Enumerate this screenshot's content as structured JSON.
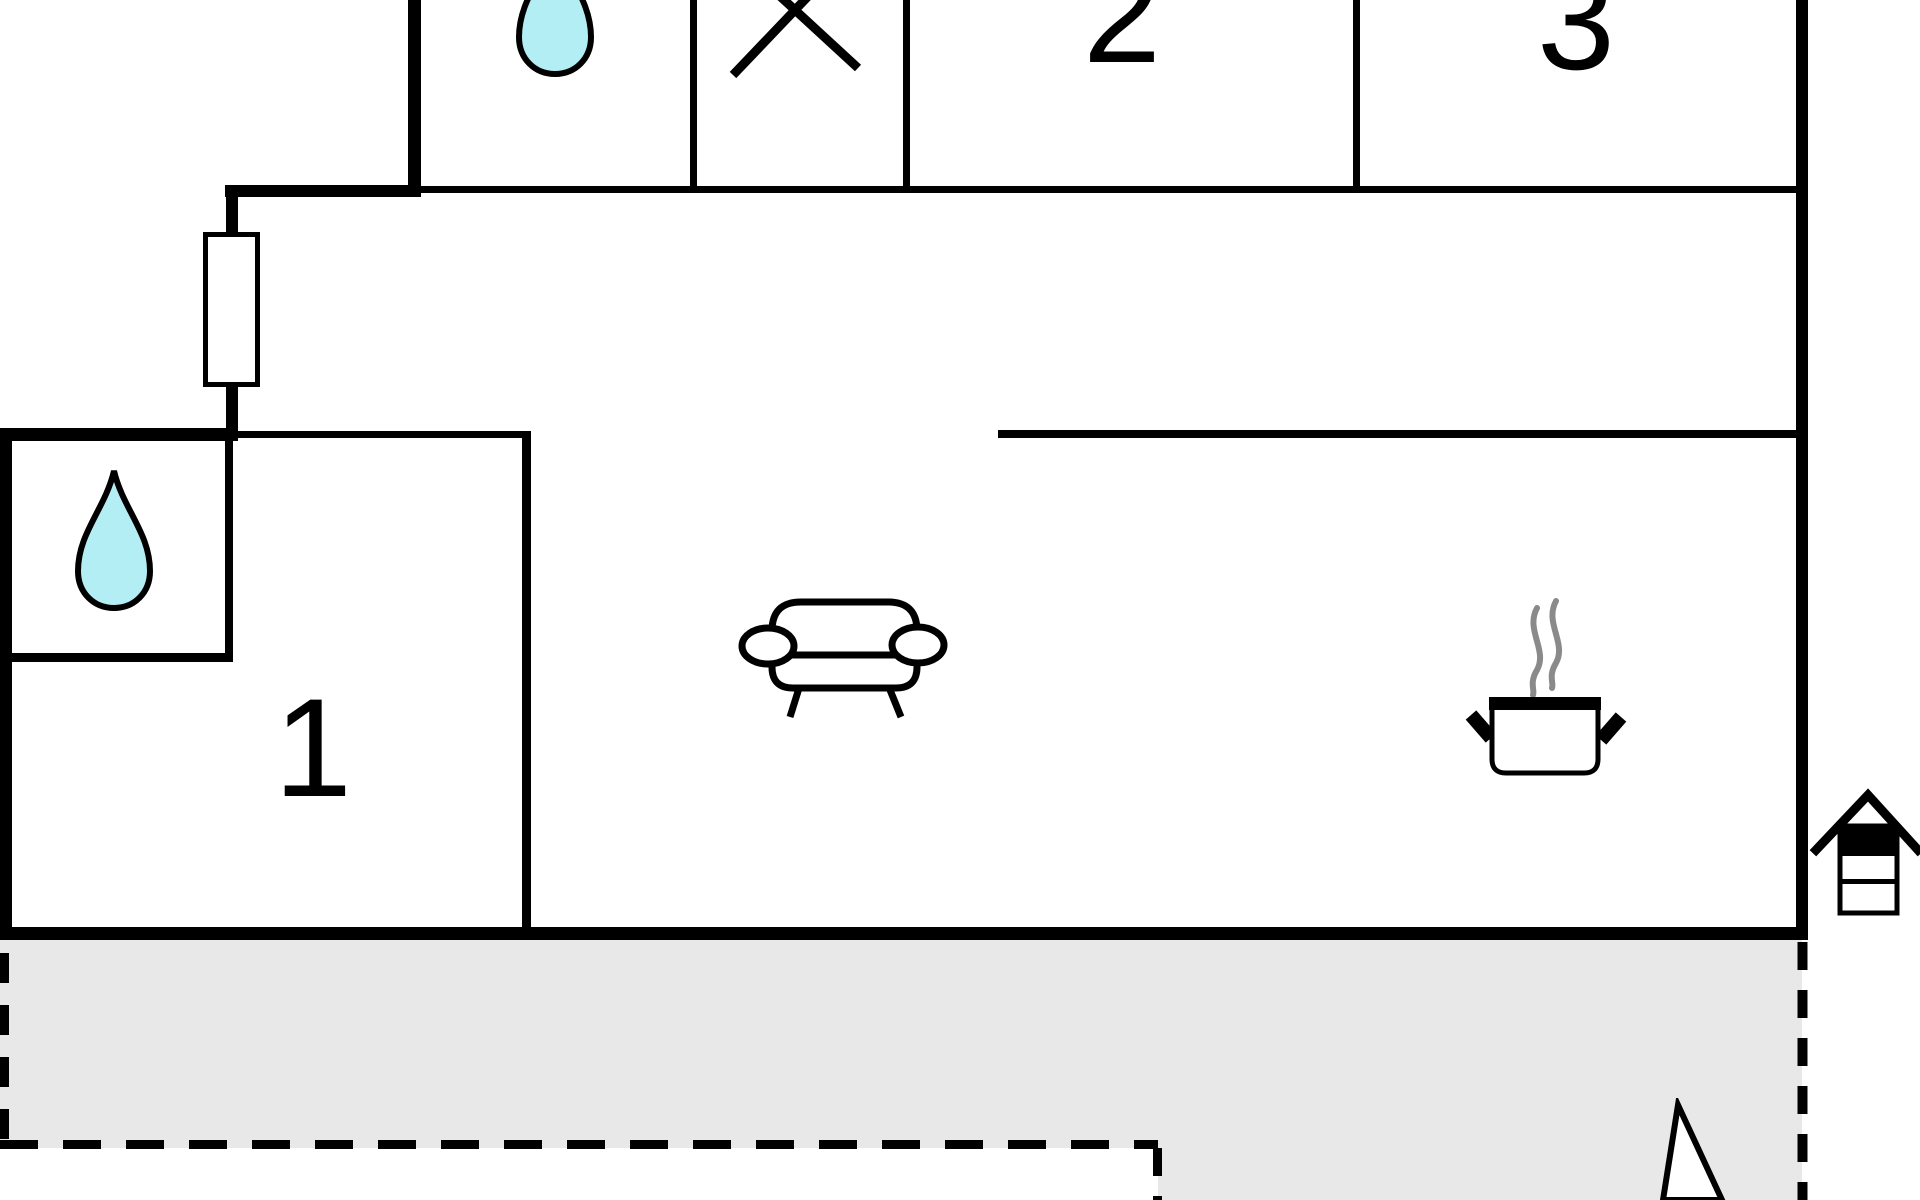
{
  "plan": {
    "type": "floor-plan",
    "rooms": {
      "bedroom1": {
        "label": "1",
        "feature_icon": "water-drop-icon"
      },
      "bedroom2": {
        "label": "2"
      },
      "bedroom3": {
        "label": "3"
      },
      "bathroom_top": {
        "label": "",
        "feature_icon": "water-drop-icon"
      },
      "utility_room": {
        "label": "",
        "feature_icon": "x-mark-icon"
      },
      "living_area": {
        "label": "",
        "feature_icon": "sofa-icon"
      },
      "kitchen_area": {
        "label": "",
        "feature_icon": "cooking-pot-icon"
      }
    },
    "outdoor": {
      "terrace": {
        "style": "dashed-outline",
        "fill": "#e8e8e8"
      },
      "well": {
        "feature_icon": "well-icon"
      },
      "north_arrow": {
        "feature_icon": "north-arrow-icon"
      }
    },
    "colors": {
      "wall": "#000000",
      "water": "#b3eef5",
      "steam": "#8a8a8a",
      "terrace": "#e8e8e8",
      "background": "#ffffff"
    }
  }
}
